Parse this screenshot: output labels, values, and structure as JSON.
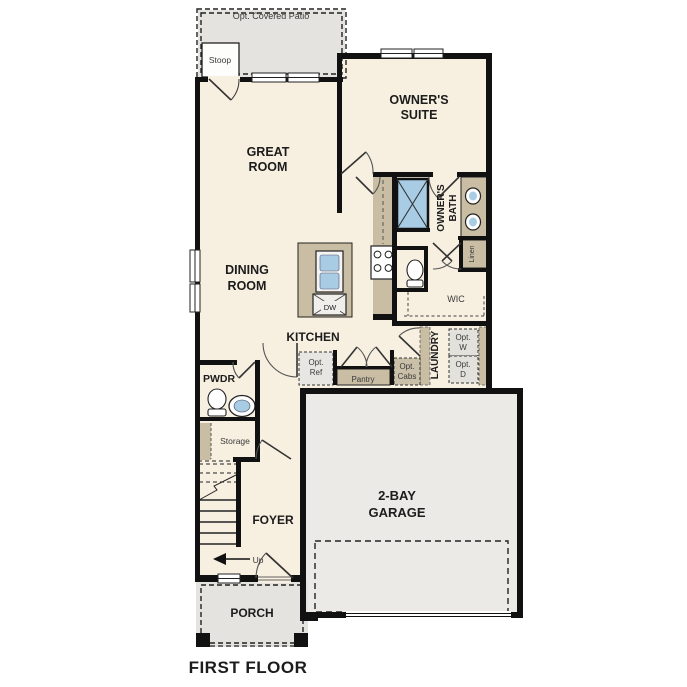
{
  "plan": {
    "title": "FIRST FLOOR",
    "rooms": {
      "patio": "Opt. Covered Patio",
      "stoop": "Stoop",
      "great_room": [
        "GREAT",
        "ROOM"
      ],
      "owners_suite": [
        "OWNER'S",
        "SUITE"
      ],
      "dining_room": [
        "DINING",
        "ROOM"
      ],
      "kitchen": "KITCHEN",
      "owners_bath": [
        "OWNER'S",
        "BATH"
      ],
      "wic": "WIC",
      "linen": "Linen",
      "laundry": "LAUNDRY",
      "pwdr": "PWDR",
      "storage": "Storage",
      "pantry": "Pantry",
      "foyer": "FOYER",
      "garage": [
        "2-BAY",
        "GARAGE"
      ],
      "porch": "PORCH"
    },
    "annotations": {
      "dw": "DW",
      "up": "Up",
      "opt_ref": [
        "Opt.",
        "Ref"
      ],
      "opt_cabs": [
        "Opt.",
        "Cabs"
      ],
      "opt_washer": [
        "Opt.",
        "W"
      ],
      "opt_dryer": [
        "Opt.",
        "D"
      ]
    },
    "colors": {
      "wall": "#111111",
      "interior_floor": "#f7f0e1",
      "outdoor_floor": "#e4e3df",
      "garage_floor": "#eceae6",
      "cabinetry": "#c9bda3",
      "plumbing_blue": "#a9cce5"
    }
  }
}
